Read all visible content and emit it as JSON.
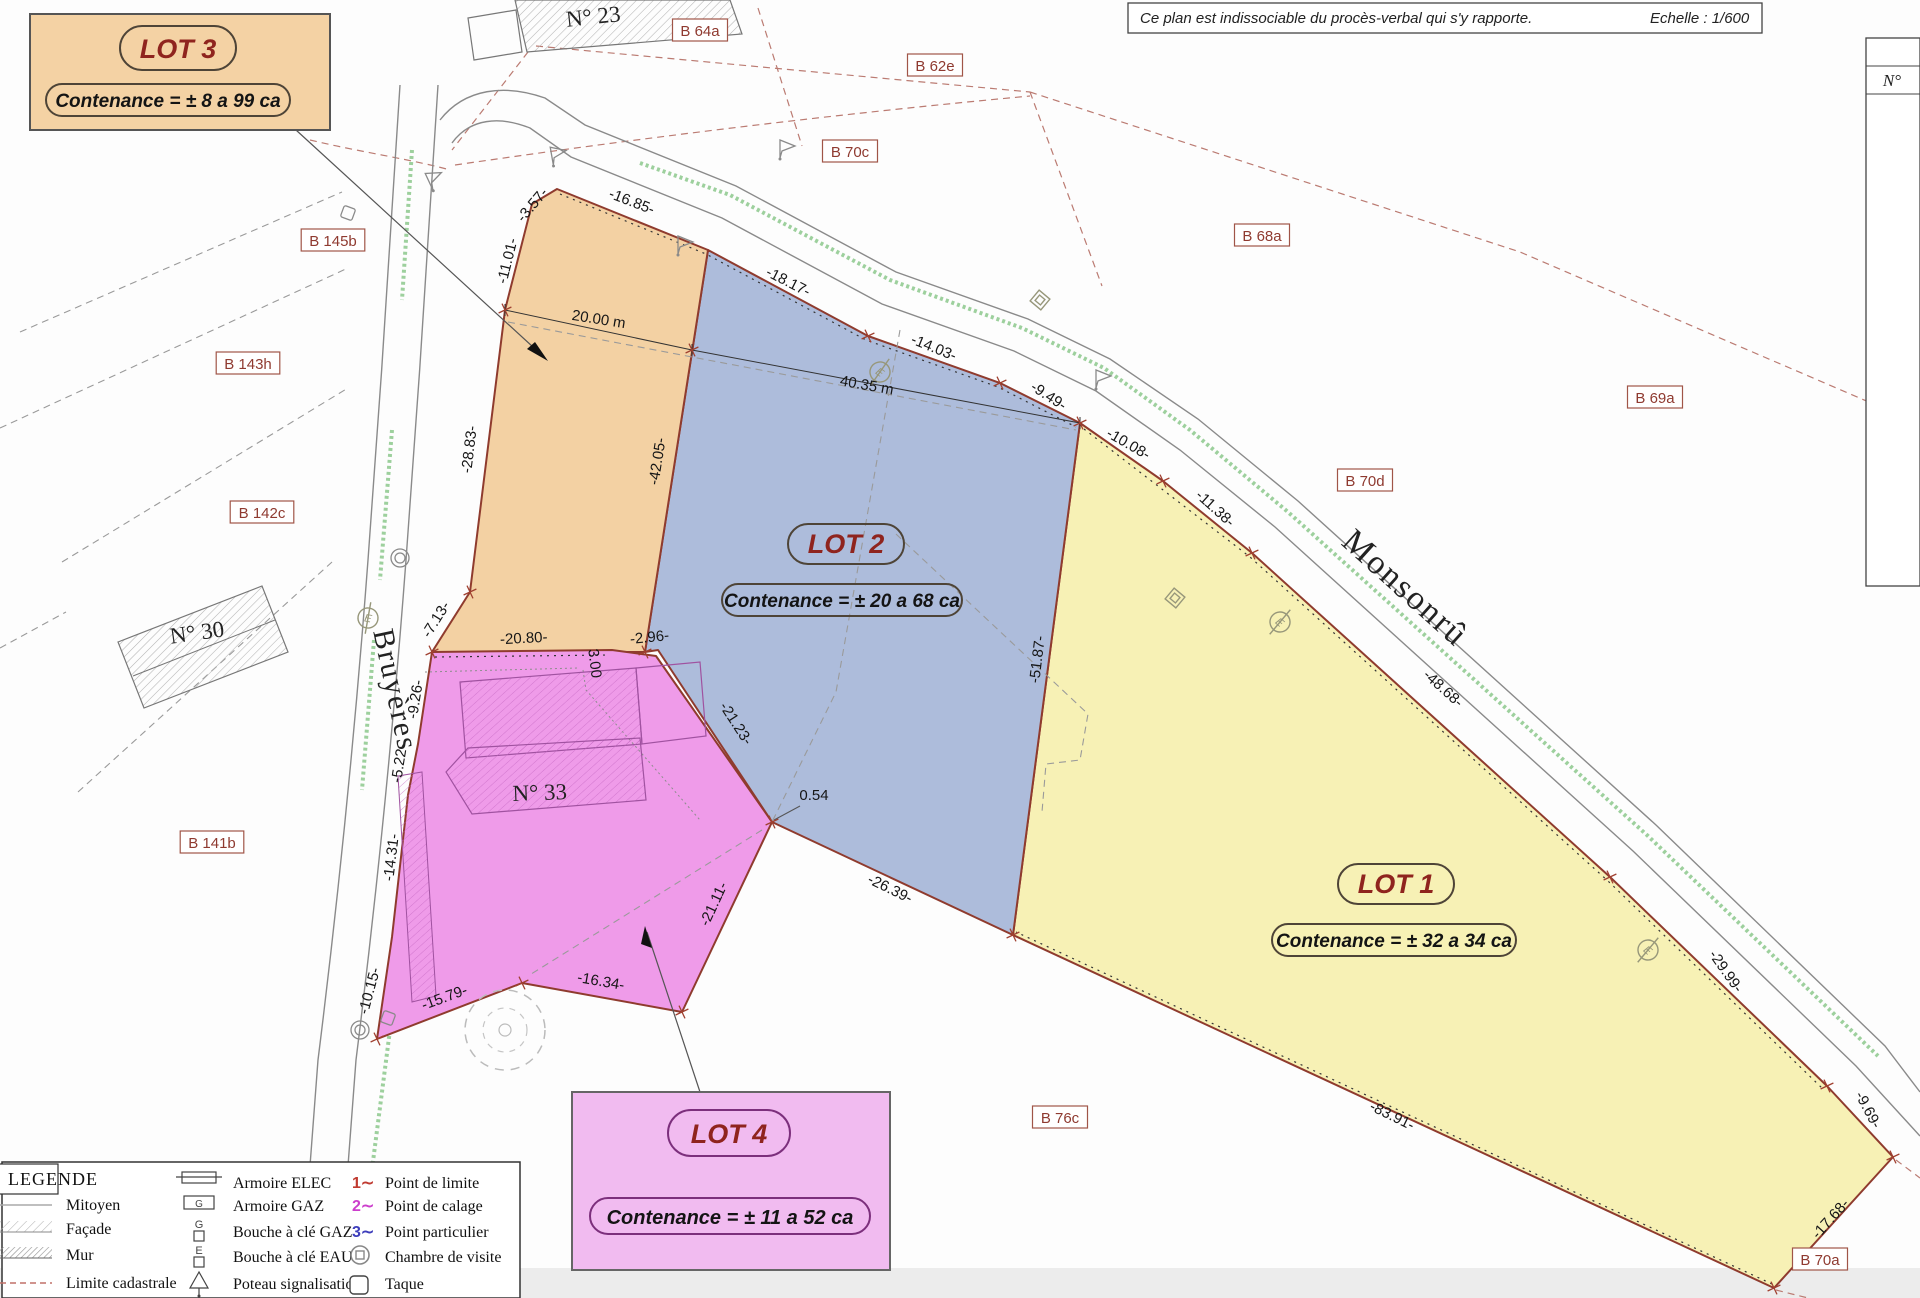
{
  "header": {
    "note": "Ce plan est indissociable du procès-verbal qui s'y rapporte.",
    "scale": "Echelle : 1/600",
    "table_header": "N°"
  },
  "lots": {
    "lot1": {
      "name": "LOT 1",
      "contenance": "Contenance = ± 32 a 34 ca",
      "color": "#f7f1b5"
    },
    "lot2": {
      "name": "LOT 2",
      "contenance": "Contenance = ± 20 a 68 ca",
      "color": "#adbcdb"
    },
    "lot3": {
      "name": "LOT 3",
      "contenance": "Contenance = ± 8 a 99 ca",
      "color": "#f3d1a3"
    },
    "lot4": {
      "name": "LOT 4",
      "contenance": "Contenance = ± 11 a 52 ca",
      "color": "#ef9be9"
    }
  },
  "parcels": [
    {
      "t": "B 64a",
      "x": 700,
      "y": 33
    },
    {
      "t": "B 62e",
      "x": 935,
      "y": 68
    },
    {
      "t": "B 70c",
      "x": 850,
      "y": 154
    },
    {
      "t": "B 68a",
      "x": 1262,
      "y": 238
    },
    {
      "t": "B 145b",
      "x": 333,
      "y": 243
    },
    {
      "t": "B 143h",
      "x": 248,
      "y": 366
    },
    {
      "t": "B 142c",
      "x": 262,
      "y": 515
    },
    {
      "t": "B 70d",
      "x": 1365,
      "y": 483
    },
    {
      "t": "B 69a",
      "x": 1655,
      "y": 400
    },
    {
      "t": "B 141b",
      "x": 212,
      "y": 845
    },
    {
      "t": "B 76c",
      "x": 1060,
      "y": 1120
    },
    {
      "t": "B 70a",
      "x": 1820,
      "y": 1262
    }
  ],
  "measurements": [
    {
      "t": "-3.57-",
      "x": 536,
      "y": 208,
      "r": -50
    },
    {
      "t": "-11.01-",
      "x": 512,
      "y": 262,
      "r": -76
    },
    {
      "t": "-28.83-",
      "x": 474,
      "y": 450,
      "r": -83
    },
    {
      "t": "-7.13-",
      "x": 440,
      "y": 622,
      "r": -58
    },
    {
      "t": "-16.85-",
      "x": 630,
      "y": 206,
      "r": 21
    },
    {
      "t": "-18.17-",
      "x": 786,
      "y": 286,
      "r": 27
    },
    {
      "t": "-14.03-",
      "x": 932,
      "y": 352,
      "r": 22
    },
    {
      "t": "-9.49-",
      "x": 1046,
      "y": 400,
      "r": 33
    },
    {
      "t": "-10.08-",
      "x": 1126,
      "y": 448,
      "r": 30
    },
    {
      "t": "-11.38-",
      "x": 1212,
      "y": 512,
      "r": 42
    },
    {
      "t": "-48.68-",
      "x": 1440,
      "y": 692,
      "r": 42
    },
    {
      "t": "-29.99-",
      "x": 1722,
      "y": 974,
      "r": 55
    },
    {
      "t": "-9.69-",
      "x": 1864,
      "y": 1112,
      "r": 62
    },
    {
      "t": "-17.68-",
      "x": 1834,
      "y": 1222,
      "r": -48
    },
    {
      "t": "-83.91-",
      "x": 1390,
      "y": 1120,
      "r": 26
    },
    {
      "t": "-26.39-",
      "x": 888,
      "y": 893,
      "r": 26
    },
    {
      "t": "-51.87-",
      "x": 1042,
      "y": 660,
      "r": -83
    },
    {
      "t": "-42.05-",
      "x": 662,
      "y": 462,
      "r": -81
    },
    {
      "t": "-20.80-",
      "x": 524,
      "y": 643,
      "r": -3
    },
    {
      "t": "-2.96-",
      "x": 650,
      "y": 642,
      "r": -6
    },
    {
      "t": "3.00",
      "x": 590,
      "y": 664,
      "r": 83
    },
    {
      "t": "-9.26-",
      "x": 420,
      "y": 700,
      "r": -81
    },
    {
      "t": "-5.22-",
      "x": 404,
      "y": 764,
      "r": -81
    },
    {
      "t": "-14.31-",
      "x": 396,
      "y": 858,
      "r": -83
    },
    {
      "t": "-10.15-",
      "x": 374,
      "y": 992,
      "r": -75
    },
    {
      "t": "-15.79-",
      "x": 446,
      "y": 1002,
      "r": -20
    },
    {
      "t": "-16.34-",
      "x": 600,
      "y": 986,
      "r": 10
    },
    {
      "t": "-21.11-",
      "x": 718,
      "y": 906,
      "r": -65
    },
    {
      "t": "-21.23-",
      "x": 732,
      "y": 726,
      "r": 57
    },
    {
      "t": "0.54",
      "x": 814,
      "y": 800,
      "r": 0
    },
    {
      "t": "20.00 m",
      "x": 598,
      "y": 324,
      "r": 9
    },
    {
      "t": "40.35 m",
      "x": 866,
      "y": 390,
      "r": 10
    }
  ],
  "streets": [
    {
      "t": "Bruyères",
      "x": 386,
      "y": 692,
      "r": 78,
      "size": 30
    },
    {
      "t": "Monsonrû",
      "x": 1398,
      "y": 596,
      "r": 42,
      "size": 34
    }
  ],
  "buildings": [
    {
      "t": "N° 23",
      "x": 594,
      "y": 24,
      "r": -6
    },
    {
      "t": "N° 30",
      "x": 198,
      "y": 640,
      "r": -8
    },
    {
      "t": "N° 33",
      "x": 540,
      "y": 800,
      "r": -2
    }
  ],
  "legend": {
    "title": "LEGENDE",
    "col1": [
      {
        "label": "Mitoyen"
      },
      {
        "label": "Façade"
      },
      {
        "label": "Mur"
      },
      {
        "label": "Limite cadastrale"
      }
    ],
    "col2": [
      {
        "label": "Armoire ELEC"
      },
      {
        "label": "Armoire GAZ"
      },
      {
        "label": "Bouche à clé GAZ"
      },
      {
        "label": "Bouche à clé EAU"
      },
      {
        "label": "Poteau signalisation"
      }
    ],
    "col3": [
      {
        "n": "1∼",
        "label": "Point de limite",
        "color": "#c03a30",
        "label_color": "#111111"
      },
      {
        "n": "2∼",
        "label": "Point de calage",
        "color": "#cc3ecc",
        "label_color": "#cc3ecc"
      },
      {
        "n": "3∼",
        "label": "Point particulier",
        "color": "#3d3dbb",
        "label_color": "#3d3dbb"
      },
      {
        "label": "Chambre de visite"
      },
      {
        "label": "Taque"
      }
    ]
  },
  "icons": {
    "flag": "signal-post-icon",
    "e_circle": "water-valve-icon",
    "diamond": "utility-marker-icon",
    "double_circle": "inspection-chamber-icon",
    "square": "taque-icon",
    "tree": "tree-icon",
    "cross_tick": "boundary-point-icon"
  },
  "colors": {
    "boundary": "#8f3b2e",
    "parcel_label": "#8f3a30",
    "lot_title": "#8f241e",
    "green_strip": "#8cc88c"
  }
}
